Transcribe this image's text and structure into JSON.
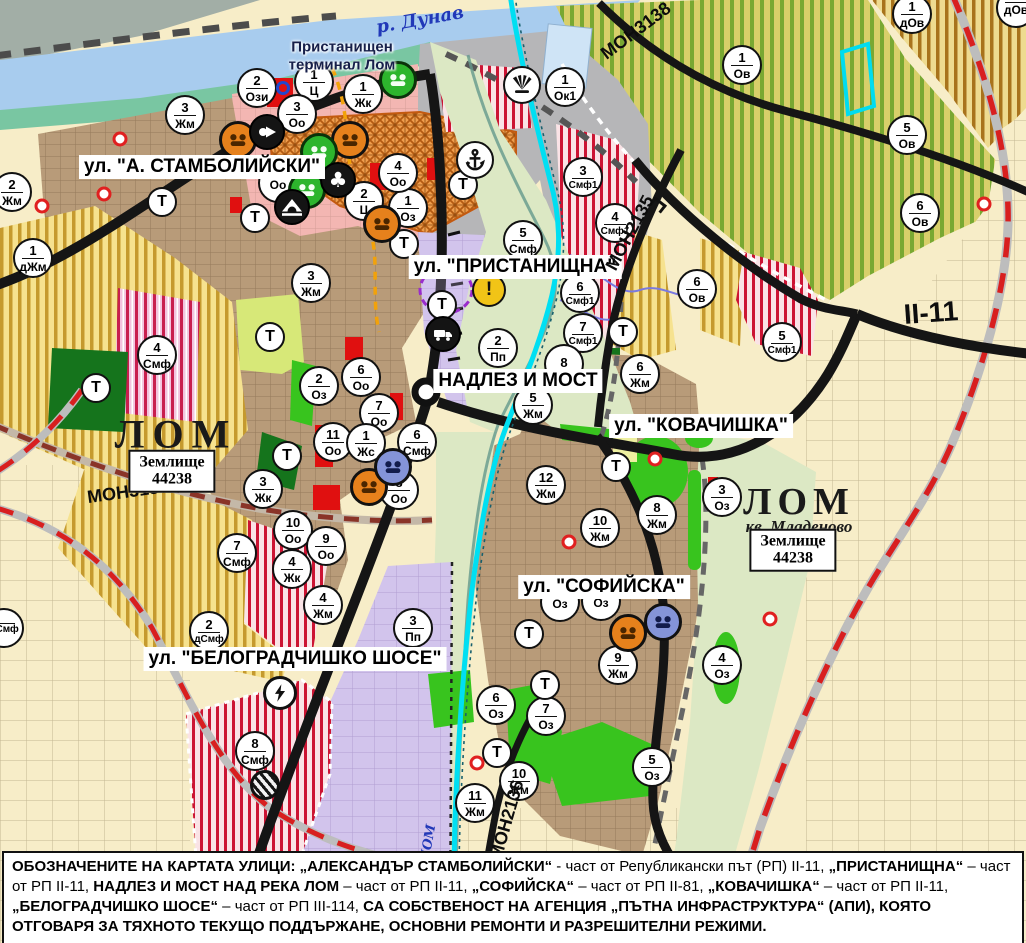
{
  "title": "Устройствена карта на гр. Лом",
  "colors": {
    "river": "#a8ccee",
    "shore": "#79c6a2",
    "port_gray": "#b6b6b8",
    "urban_brown": "#b89b79",
    "industrial_lilac": "#d2c4ec",
    "valley_green": "#dce8c4",
    "vineyard": "#d8cf6a",
    "vineyard_stripe": "#79a832",
    "agri_yellow": "#f6e28f",
    "agri_stripe": "#c59a2e",
    "smf_stripe": "#cc1433",
    "park_green": "#15741c",
    "oz_green": "#38c41e",
    "road_black": "#151515",
    "railway_red": "#d81f1f",
    "canal_cyan": "#00dff2",
    "marker_orange": "#e6811c",
    "marker_green": "#2db52d",
    "marker_blue": "#8494d8",
    "warning_yellow": "#f1c417"
  },
  "street_labels": [
    {
      "text": "ул. \"А. СТАМБОЛИЙСКИ\"",
      "x": 202,
      "y": 167
    },
    {
      "text": "ул. \"ПРИСТАНИЩНА\"",
      "x": 515,
      "y": 267
    },
    {
      "text": "НАДЛЕЗ И МОСТ",
      "x": 518,
      "y": 381
    },
    {
      "text": "ул. \"КОВАЧИШКА\"",
      "x": 701,
      "y": 426
    },
    {
      "text": "ул. \"СОФИЙСКА\"",
      "x": 604,
      "y": 587
    },
    {
      "text": "ул. \"БЕЛОГРАДЧИШКО ШОСЕ\"",
      "x": 295,
      "y": 659
    }
  ],
  "map_texts": [
    {
      "text": "р. Дунав",
      "cls": "river",
      "x": 420,
      "y": 20,
      "rot": -10
    },
    {
      "text": "Пристанищен",
      "cls": "terminal",
      "x": 342,
      "y": 47,
      "rot": 0
    },
    {
      "text": "терминал Лом",
      "cls": "terminal",
      "x": 342,
      "y": 65,
      "rot": 0
    },
    {
      "text": "ЛОМ",
      "cls": "city",
      "x": 176,
      "y": 434,
      "rot": 0
    },
    {
      "text": "ЛОМ",
      "cls": "city-sm",
      "x": 799,
      "y": 502,
      "rot": 0
    },
    {
      "text": "кв. Младеново",
      "cls": "quarter",
      "x": 799,
      "y": 527,
      "rot": 0
    },
    {
      "text": "МОН3139",
      "cls": "road",
      "x": 128,
      "y": 492,
      "rot": -8
    },
    {
      "text": "МОН3138",
      "cls": "road",
      "x": 636,
      "y": 31,
      "rot": -37
    },
    {
      "text": "МОН2135",
      "cls": "road",
      "x": 630,
      "y": 233,
      "rot": -62
    },
    {
      "text": "МОН2136",
      "cls": "road",
      "x": 507,
      "y": 820,
      "rot": -74
    },
    {
      "text": "II-11",
      "cls": "highway",
      "x": 931,
      "y": 313,
      "rot": -4
    },
    {
      "text": "р. ЛОМ",
      "cls": "river-sm",
      "x": 427,
      "y": 852,
      "rot": -80
    }
  ],
  "area_boxes": [
    {
      "lines": [
        "Землище",
        "44238"
      ],
      "x": 172,
      "y": 471
    },
    {
      "lines": [
        "Землище",
        "44238"
      ],
      "x": 793,
      "y": 550
    }
  ],
  "t_label": "Т",
  "t_markers": [
    {
      "x": 162,
      "y": 202
    },
    {
      "x": 255,
      "y": 218
    },
    {
      "x": 463,
      "y": 185
    },
    {
      "x": 404,
      "y": 244
    },
    {
      "x": 442,
      "y": 305
    },
    {
      "x": 623,
      "y": 332
    },
    {
      "x": 270,
      "y": 337
    },
    {
      "x": 96,
      "y": 388
    },
    {
      "x": 287,
      "y": 456
    },
    {
      "x": 616,
      "y": 467
    },
    {
      "x": 529,
      "y": 634
    },
    {
      "x": 545,
      "y": 685
    },
    {
      "x": 497,
      "y": 753
    }
  ],
  "zone_markers": [
    {
      "n": "2",
      "z": "Ози",
      "x": 257,
      "y": 88
    },
    {
      "n": "1",
      "z": "Ц",
      "x": 314,
      "y": 82
    },
    {
      "n": "1",
      "z": "Жк",
      "x": 363,
      "y": 94
    },
    {
      "n": "3",
      "z": "Оо",
      "x": 297,
      "y": 114
    },
    {
      "n": "3",
      "z": "Жм",
      "x": 185,
      "y": 115
    },
    {
      "n": "1",
      "z": "Ок1",
      "x": 565,
      "y": 87
    },
    {
      "n": "1",
      "z": "Ов",
      "x": 742,
      "y": 65
    },
    {
      "n": "1",
      "z": "дОв",
      "x": 912,
      "y": 14
    },
    {
      "n": "",
      "z": "дОв",
      "x": 1016,
      "y": 8
    },
    {
      "n": "5",
      "z": "Ов",
      "x": 907,
      "y": 135
    },
    {
      "n": "2",
      "z": "Жм",
      "x": 12,
      "y": 192
    },
    {
      "n": "1",
      "z": "дЖм",
      "x": 33,
      "y": 258
    },
    {
      "n": "2",
      "z": "Ц",
      "x": 364,
      "y": 201
    },
    {
      "n": "1",
      "z": "Оз",
      "x": 408,
      "y": 208
    },
    {
      "n": "4",
      "z": "Оо",
      "x": 398,
      "y": 173
    },
    {
      "n": "",
      "z": "Оо",
      "x": 278,
      "y": 183
    },
    {
      "n": "3",
      "z": "Смф1",
      "x": 583,
      "y": 177
    },
    {
      "n": "4",
      "z": "Смф1",
      "x": 615,
      "y": 223
    },
    {
      "n": "5",
      "z": "Смф",
      "x": 523,
      "y": 240
    },
    {
      "n": "6",
      "z": "Ов",
      "x": 697,
      "y": 289
    },
    {
      "n": "6",
      "z": "Ов",
      "x": 920,
      "y": 213
    },
    {
      "n": "3",
      "z": "Жм",
      "x": 311,
      "y": 283
    },
    {
      "n": "6",
      "z": "Смф1",
      "x": 580,
      "y": 293
    },
    {
      "n": "7",
      "z": "Смф1",
      "x": 583,
      "y": 333
    },
    {
      "n": "5",
      "z": "Смф1",
      "x": 782,
      "y": 342
    },
    {
      "n": "2",
      "z": "Пп",
      "x": 498,
      "y": 348
    },
    {
      "n": "2",
      "z": "Оз",
      "x": 319,
      "y": 386
    },
    {
      "n": "6",
      "z": "Оо",
      "x": 361,
      "y": 377
    },
    {
      "n": "7",
      "z": "Оо",
      "x": 379,
      "y": 413
    },
    {
      "n": "4",
      "z": "Смф",
      "x": 157,
      "y": 355
    },
    {
      "n": "8",
      "z": "",
      "x": 564,
      "y": 364
    },
    {
      "n": "5",
      "z": "Жм",
      "x": 533,
      "y": 405
    },
    {
      "n": "6",
      "z": "Жм",
      "x": 640,
      "y": 374
    },
    {
      "n": "11",
      "z": "Оо",
      "x": 333,
      "y": 442
    },
    {
      "n": "1",
      "z": "Жс",
      "x": 366,
      "y": 443
    },
    {
      "n": "6",
      "z": "Смф",
      "x": 417,
      "y": 442
    },
    {
      "n": "12",
      "z": "Жм",
      "x": 546,
      "y": 485
    },
    {
      "n": "8",
      "z": "Оо",
      "x": 399,
      "y": 490
    },
    {
      "n": "3",
      "z": "Жк",
      "x": 263,
      "y": 489
    },
    {
      "n": "3",
      "z": "Оз",
      "x": 722,
      "y": 497
    },
    {
      "n": "10",
      "z": "Оо",
      "x": 293,
      "y": 530
    },
    {
      "n": "8",
      "z": "Жм",
      "x": 657,
      "y": 515
    },
    {
      "n": "10",
      "z": "Жм",
      "x": 600,
      "y": 528
    },
    {
      "n": "9",
      "z": "Оо",
      "x": 326,
      "y": 546
    },
    {
      "n": "7",
      "z": "Смф",
      "x": 237,
      "y": 553
    },
    {
      "n": "4",
      "z": "Жк",
      "x": 292,
      "y": 569
    },
    {
      "n": "",
      "z": "Оз",
      "x": 560,
      "y": 602
    },
    {
      "n": "",
      "z": "Оз",
      "x": 601,
      "y": 601
    },
    {
      "n": "4",
      "z": "Жм",
      "x": 323,
      "y": 605
    },
    {
      "n": "2",
      "z": "дСмф",
      "x": 209,
      "y": 631
    },
    {
      "n": "",
      "z": "дСмф",
      "x": 4,
      "y": 628
    },
    {
      "n": "3",
      "z": "Пп",
      "x": 413,
      "y": 628
    },
    {
      "n": "9",
      "z": "Жм",
      "x": 618,
      "y": 665
    },
    {
      "n": "6",
      "z": "Оз",
      "x": 496,
      "y": 705
    },
    {
      "n": "7",
      "z": "Оз",
      "x": 546,
      "y": 716
    },
    {
      "n": "4",
      "z": "Оз",
      "x": 722,
      "y": 665
    },
    {
      "n": "10",
      "z": "Жм",
      "x": 519,
      "y": 781
    },
    {
      "n": "11",
      "z": "Жм",
      "x": 475,
      "y": 803
    },
    {
      "n": "5",
      "z": "Оз",
      "x": 652,
      "y": 767
    },
    {
      "n": "8",
      "z": "Смф",
      "x": 255,
      "y": 751
    }
  ],
  "icon_markers": [
    {
      "type": "heritage",
      "variant": "orange",
      "x": 238,
      "y": 140
    },
    {
      "type": "heritage",
      "variant": "orange",
      "x": 350,
      "y": 140
    },
    {
      "type": "heritage",
      "variant": "orange",
      "x": 382,
      "y": 224
    },
    {
      "type": "heritage",
      "variant": "orange",
      "x": 369,
      "y": 487
    },
    {
      "type": "heritage",
      "variant": "orange",
      "x": 628,
      "y": 633
    },
    {
      "type": "heritage",
      "variant": "green",
      "x": 398,
      "y": 80
    },
    {
      "type": "heritage",
      "variant": "green",
      "x": 319,
      "y": 152
    },
    {
      "type": "heritage",
      "variant": "green",
      "x": 307,
      "y": 190
    },
    {
      "type": "heritage",
      "variant": "blue",
      "x": 393,
      "y": 467
    },
    {
      "type": "heritage",
      "variant": "blue",
      "x": 663,
      "y": 622
    },
    {
      "type": "arrow-right",
      "x": 267,
      "y": 132
    },
    {
      "type": "club",
      "x": 338,
      "y": 180
    },
    {
      "type": "tunnel",
      "x": 292,
      "y": 207
    },
    {
      "type": "anchor",
      "x": 475,
      "y": 160
    },
    {
      "type": "fan",
      "x": 522,
      "y": 85
    },
    {
      "type": "truck",
      "x": 443,
      "y": 334
    },
    {
      "type": "lightning",
      "x": 280,
      "y": 693
    },
    {
      "type": "hatched",
      "x": 265,
      "y": 785
    },
    {
      "type": "warning",
      "x": 489,
      "y": 290,
      "text": "!"
    }
  ],
  "red_dots": [
    {
      "x": 120,
      "y": 139
    },
    {
      "x": 104,
      "y": 194
    },
    {
      "x": 42,
      "y": 206
    },
    {
      "x": 655,
      "y": 459
    },
    {
      "x": 569,
      "y": 542
    },
    {
      "x": 477,
      "y": 763
    },
    {
      "x": 770,
      "y": 619
    },
    {
      "x": 984,
      "y": 204
    }
  ],
  "blue_rings": [
    {
      "x": 283,
      "y": 88
    }
  ],
  "bridge_symbols": [
    {
      "x": 658,
      "y": 205,
      "rot": 38
    }
  ],
  "footer": {
    "segments": [
      {
        "t": "ОБОЗНАЧЕНИТЕ НА КАРТАТА УЛИЦИ: „АЛЕКСАНДЪР СТАМБОЛИЙСКИ“",
        "b": true
      },
      {
        "t": " - част от Републикански път (РП) II-11, ",
        "b": false
      },
      {
        "t": "„ПРИСТАНИЩНА“",
        "b": true
      },
      {
        "t": " – част от РП II-11, ",
        "b": false
      },
      {
        "t": "НАДЛЕЗ И МОСТ НАД РЕКА ЛОМ",
        "b": true
      },
      {
        "t": " – част от РП II-11, ",
        "b": false
      },
      {
        "t": "„СОФИЙСКА“",
        "b": true
      },
      {
        "t": " – част от РП II-81, ",
        "b": false
      },
      {
        "t": "„КОВАЧИШКА“",
        "b": true
      },
      {
        "t": " – част от РП II-11, ",
        "b": false
      },
      {
        "t": "„БЕЛОГРАДЧИШКО ШОСЕ“",
        "b": true
      },
      {
        "t": " – част от РП III-114, ",
        "b": false
      },
      {
        "t": "СА СОБСТВЕНОСТ НА АГЕНЦИЯ „ПЪТНА ИНФРАСТРУКТУРА“ (АПИ), КОЯТО ОТГОВАРЯ ЗА ТЯХНОТО ТЕКУЩО ПОДДЪРЖАНЕ, ОСНОВНИ РЕМОНТИ И РАЗРЕШИТЕЛНИ РЕЖИМИ.",
        "b": true
      }
    ]
  }
}
